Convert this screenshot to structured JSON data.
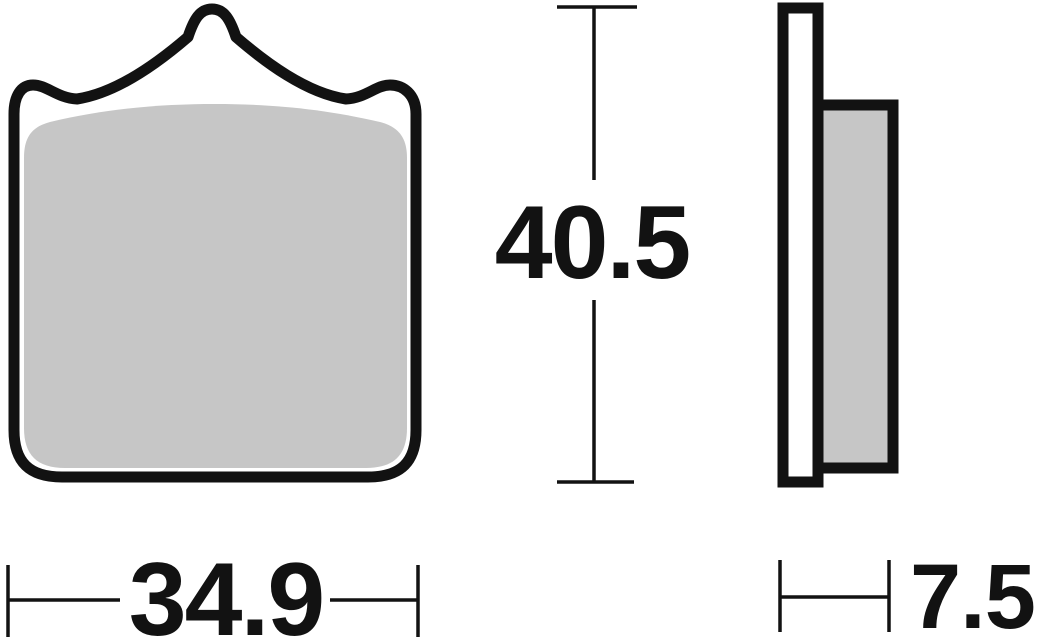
{
  "drawing": {
    "background_color": "#ffffff",
    "outline_color": "#121212",
    "friction_pad_fill_color": "#c6c6c6",
    "backplate_fill_color": "#ffffff",
    "dimension_line_color": "#121212",
    "views": {
      "front_view_label": "brake-pad-front-view",
      "side_view_label": "brake-pad-side-view"
    },
    "dimensions": {
      "width": {
        "value": "34.9"
      },
      "height": {
        "value": "40.5"
      },
      "thickness": {
        "value": "7.5"
      }
    }
  }
}
